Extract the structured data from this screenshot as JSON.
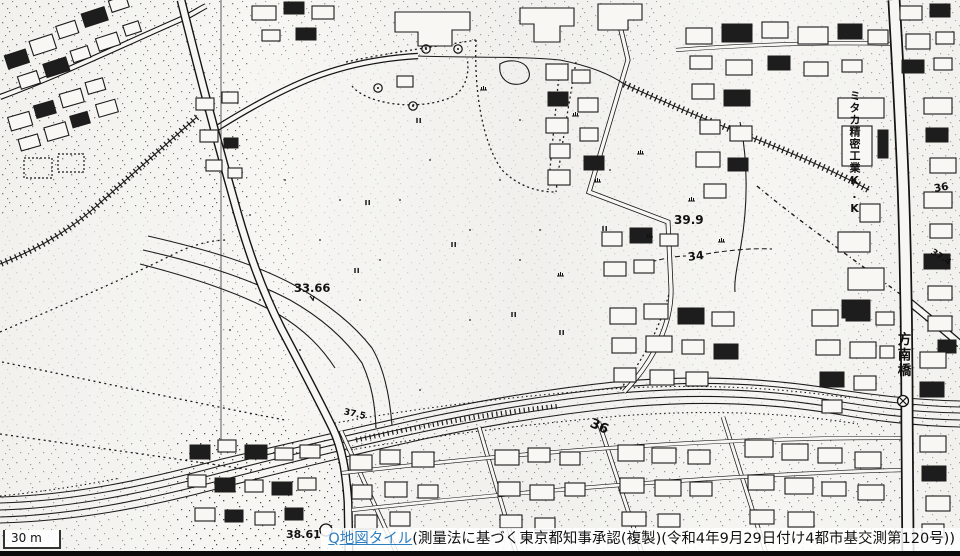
{
  "map": {
    "labels": {
      "spot_33_66": "33.66",
      "spot_39_9": "39.9",
      "contour_34": "34",
      "river_36": "36",
      "edge_36": "36",
      "edge_37_4": "37.4",
      "spot_38_61": "38.61",
      "spot_37_5": "37.5",
      "factory_vertical": "ミタカ精密工業K.K",
      "bridge_vertical": "方南橋"
    },
    "scale_bar": {
      "label": "30 m"
    },
    "attribution": {
      "link": "Q地図タイル",
      "text": "(測量法に基づく東京都知事承認(複製)(令和4年9月29日付け4都市基交測第120号))",
      "link_color": "#2e7fc2"
    }
  }
}
